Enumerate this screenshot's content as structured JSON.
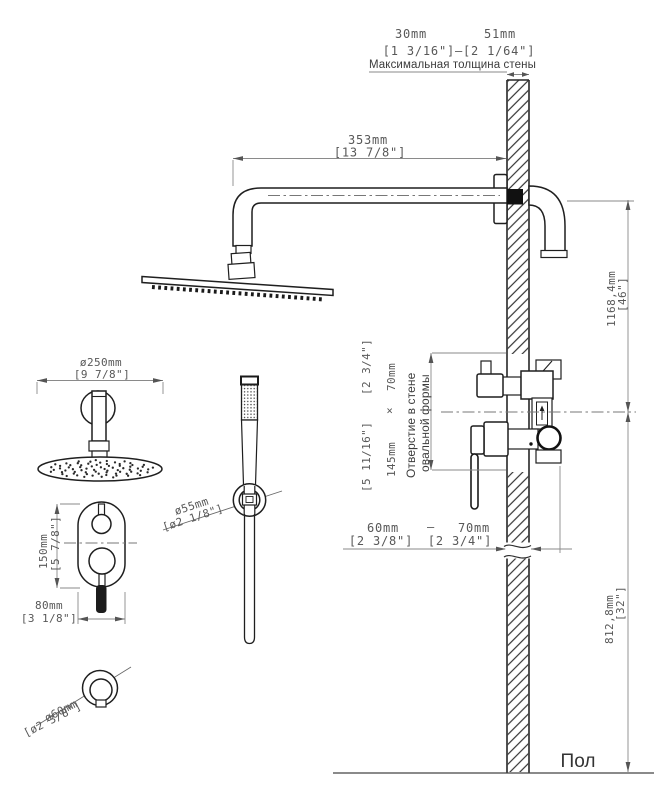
{
  "labels": {
    "max_wall": "Максимальная толщина стены",
    "hole1": "Отверстие в стене",
    "hole2": "овальной формы",
    "floor": "Пол"
  },
  "dims": {
    "wall_min": "30mm",
    "wall_max": "51mm",
    "wall_in": "[1 3/16\"]—[2 1/64\"]",
    "arm": "353mm",
    "arm_in": "[13 7/8\"]",
    "head": "ø250mm",
    "head_in": "[9 7/8\"]",
    "hand": "ø55mm",
    "hand_in": "[ø2 1/8\"]",
    "mixer_h": "150mm",
    "mixer_h_in": "[5 7/8\"]",
    "mixer_w": "80mm",
    "mixer_w_in": "[3 1/8\"]",
    "outlet": "ø60mm",
    "outlet_in": "[ø2 3/8\"]",
    "hole_h": "145mm",
    "hole_times": "×",
    "hole_w": "70mm",
    "hole_h_in": "[5 11/16\"]",
    "hole_w_in": "[2 3/4\"]",
    "depth_min": "60mm",
    "depth_dash": "—",
    "depth_max": "70mm",
    "depth_min_in": "[2 3/8\"]",
    "depth_max_in": "[2 3/4\"]",
    "upper": "1168,4mm",
    "upper_in": "[46\"]",
    "lower": "812,8mm",
    "lower_in": "[32\"]"
  }
}
